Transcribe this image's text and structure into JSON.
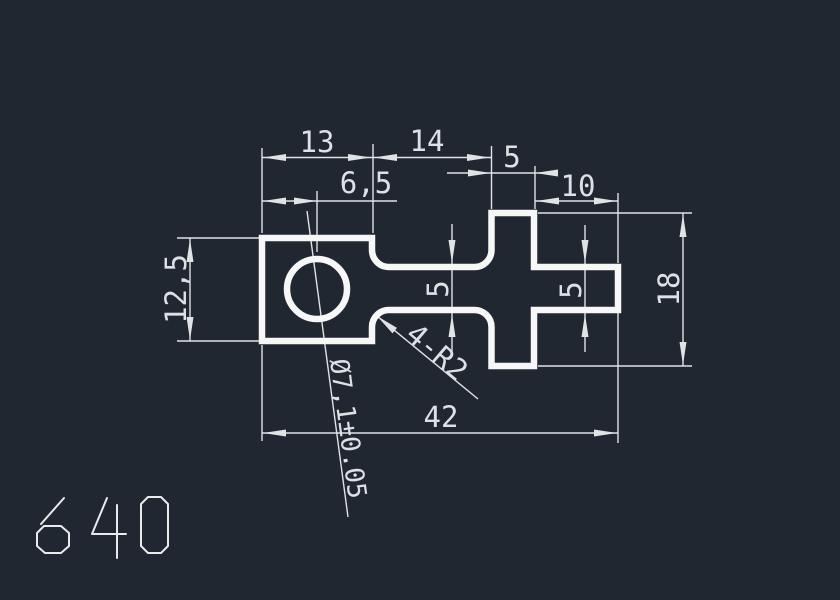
{
  "viewport": {
    "background": "#212731",
    "outline_color": "#f7f7f7",
    "dimension_color": "#dfe3e6"
  },
  "drawing": {
    "number": "640",
    "dimensions": {
      "block_width": "13",
      "neck_length": "14",
      "cross_bar_width": "5",
      "stub_length": "10",
      "hole_center_offset": "6,5",
      "block_height": "12,5",
      "neck_height": "5",
      "stub_height": "5",
      "cross_height": "18",
      "overall_length": "42",
      "fillet_note": "4-R2",
      "hole_diameter": "Ø7,1±0.05"
    }
  }
}
